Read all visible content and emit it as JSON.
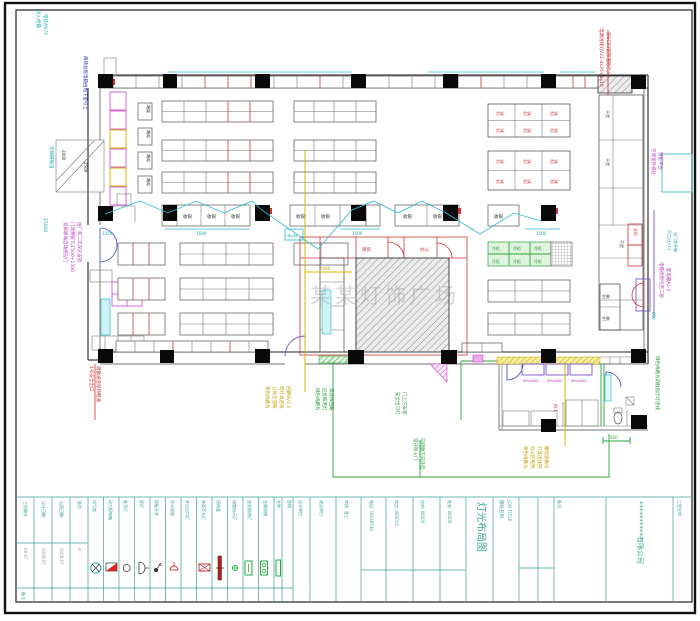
{
  "annotations": {
    "top_left_1": "消火栓箱",
    "top_left_2": "暗装AN75",
    "left_upper": "商场总配电箱由地下室引上",
    "ramp_label": "无障碍坡道",
    "ramp_dim1": "2000",
    "ramp_dim2": "2500",
    "left_dim": "15000",
    "door_note_1": "双扇玻璃自动感应门",
    "door_note_2": "门洞预留TL1500+1500",
    "door_note_3": "由厂家二次深化安装",
    "left_red_1": "1号安全出口",
    "left_red_2": "疏散通道保持畅通",
    "top_right_red_1": "电源进线YJV22-4x35+1x16",
    "top_right_red_2": "穿SC50钢管埋地引入",
    "ac_note_1": "空调室外机位",
    "ac_note_2": "预留平台",
    "right_mid_note_1": "电缆桥架引至二层",
    "right_mid_note_2": "配电箱AL-2",
    "staff_note_1": "员工出入口",
    "staff_note_2": "含门禁系统",
    "right_green_note": "绿色线路为疏散指示灯连线",
    "yellow_center": [
      "黄色线路为",
      "公共走道照",
      "明灯具连线",
      "回路BV2.5"
    ],
    "green_center": [
      "绿色线路为",
      "应急照明灯",
      "具连线回路"
    ],
    "green_mid": [
      "安全出口灯",
      "门上方安装"
    ],
    "green_door": [
      "常开防火门",
      "向疏散方向开启"
    ],
    "yellow_right": [
      "黄色线路为",
      "办公区照明",
      "灯具连线回",
      "路暗装敷设"
    ],
    "red_box_label": "AL1",
    "hydrant": "消火栓",
    "store_label": "库房",
    "office_label": "办公",
    "watermark": "某某灯饰广场",
    "dims": {
      "d500": "500",
      "d850": "850",
      "d1600": "1600",
      "d1500": "1500",
      "d5000": "5000",
      "d1350": "1350"
    }
  },
  "cells": {
    "checkout": "收银",
    "end_rack": "端架",
    "shelf": "货架",
    "cooler": "冷柜",
    "freezer": "冰柜",
    "dry": "干货",
    "fresh": "生鲜",
    "counter_dim": "900x600"
  },
  "legend": {
    "col_name": "名称",
    "col_symbol": "图例",
    "note_row": "备注",
    "items": [
      "排气扇",
      "动力配电箱",
      "吸顶灯",
      "壁灯",
      "跷板开关",
      "防水插座",
      "安全出口灯",
      "单管荧光灯",
      "接线盒",
      "疏散指示灯",
      "应急照明灯",
      "金属线槽"
    ]
  },
  "left_table": {
    "cols": [
      {
        "top": "工程编号",
        "bottom": "08-07"
      },
      {
        "top": "设计日期",
        "bottom": "2008.07"
      },
      {
        "top": "出图日期",
        "bottom": "2008.07"
      },
      {
        "top": "版次",
        "bottom": "A"
      }
    ]
  },
  "title_block": {
    "fields": [
      "设计单位:",
      "建设单位:",
      "审核: 潘工",
      "电话: 18148530",
      "审定: 083015",
      "校对: 08305",
      "批准: 08305"
    ],
    "job_title_label": "图纸名称:",
    "job_title_en": "JOB TITLE",
    "drawing_title": "灯光布局图",
    "notes_label": "备注:",
    "project_label": "工程名称:",
    "company": "**********有限公司"
  }
}
